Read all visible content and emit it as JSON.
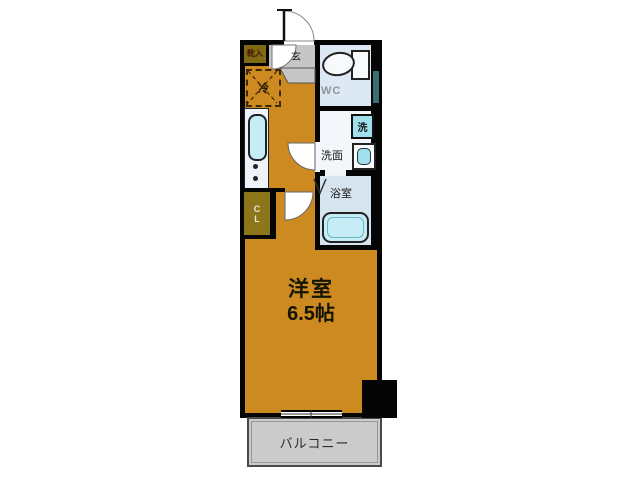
{
  "plan": {
    "kind": "apartment-floor-plan",
    "labels": {
      "main_room": "洋室",
      "main_room_size": "6.5帖",
      "balcony": "バルコニー",
      "wc": "WC",
      "washroom": "洗面",
      "bathroom": "浴室",
      "washer": "洗",
      "entrance": "玄",
      "refrigerator": "冷",
      "shoe_cabinet": "靴入",
      "closet_line1": "C",
      "closet_line2": "L"
    },
    "colors": {
      "background": "#ffffff",
      "wall": "#050505",
      "room_floor_orange": "#cd8a21",
      "closet_olive": "#8c7619",
      "entrance_gray": "#c6c6c6",
      "balcony_gray": "#cbcbcb",
      "wc_floor": "#dce8f3",
      "washroom_floor": "#f3f6fa",
      "bathroom_floor": "#d5e4ef",
      "fixture_cyan": "#9fe0ec",
      "duct_teal": "#3a6e72"
    }
  }
}
